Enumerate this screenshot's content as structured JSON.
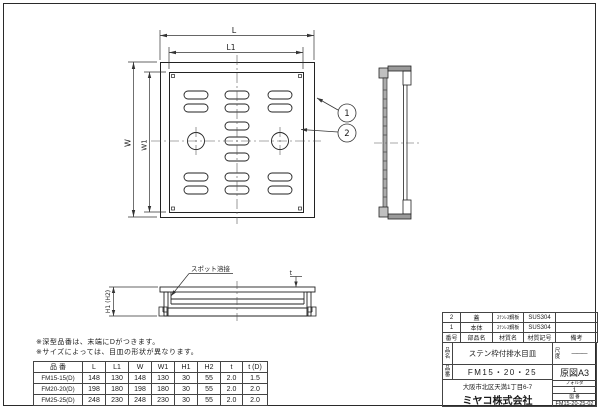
{
  "sheet": {
    "views": {
      "top_view": {
        "dim_L": "L",
        "dim_L1": "L1",
        "dim_W": "W",
        "dim_W1": "W1",
        "callout_1": "1",
        "callout_2": "2"
      },
      "section_view": {
        "spot_weld_label": "スポット溶接",
        "dim_height": "H1 (H2)",
        "dim_thickness": "t"
      }
    },
    "notes": {
      "line1": "※深型品番は、末端にDがつきます。",
      "line2": "※サイズによっては、目皿の形状が異なります。"
    },
    "dim_table": {
      "headers": [
        "品 番",
        "L",
        "L1",
        "W",
        "W1",
        "H1",
        "H2",
        "t",
        "t (D)"
      ],
      "rows": [
        [
          "FM15-15(D)",
          "148",
          "130",
          "148",
          "130",
          "30",
          "55",
          "2.0",
          "1.5"
        ],
        [
          "FM20-20(D)",
          "198",
          "180",
          "198",
          "180",
          "30",
          "55",
          "2.0",
          "2.0"
        ],
        [
          "FM25-25(D)",
          "248",
          "230",
          "248",
          "230",
          "30",
          "55",
          "2.0",
          "2.0"
        ]
      ]
    },
    "parts_table": {
      "headers": [
        "番号",
        "部品名",
        "材質名",
        "材質記号",
        "備考"
      ],
      "rows": [
        [
          "2",
          "蓋",
          "ｽﾃﾝﾚｽ鋼板",
          "SUS304",
          ""
        ],
        [
          "1",
          "本体",
          "ｽﾃﾝﾚｽ鋼板",
          "SUS304",
          ""
        ]
      ]
    },
    "title_block": {
      "name_label": "品名",
      "name_value": "ステン枠付排水目皿",
      "number_label": "品番",
      "number_value": "FM15・20・25",
      "scale_label": "尺度",
      "scale_value": "———",
      "paper": "原図A3",
      "folder_label": "フォルダ",
      "folder_value": "1",
      "dwg_no_label": "図 番",
      "dwg_no_value": "FM15-20-25-02",
      "address": "大阪市北区天満1丁目6-7",
      "company": "ミヤコ株式会社"
    }
  }
}
